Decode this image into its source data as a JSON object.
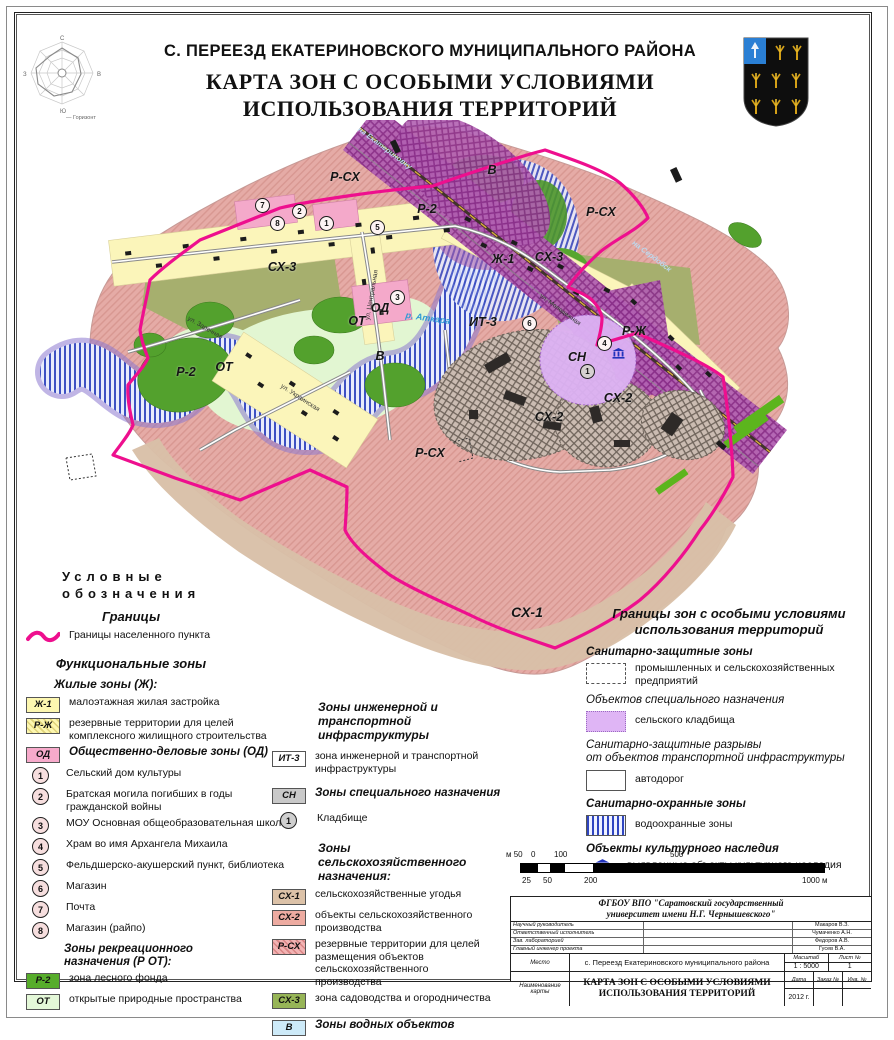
{
  "header": {
    "subtitle": "С. ПЕРЕЕЗД ЕКАТЕРИНОВСКОГО МУНИЦИПАЛЬНОГО РАЙОНА",
    "title_l1": "КАРТА ЗОН С ОСОБЫМИ УСЛОВИЯМИ",
    "title_l2": "ИСПОЛЬЗОВАНИЯ ТЕРРИТОРИЙ",
    "compass": {
      "n": "С",
      "e": "В",
      "s": "Ю",
      "w": "З",
      "caption": "— Горизонт"
    }
  },
  "map": {
    "zone_labels": [
      {
        "t": "Р-СХ"
      },
      {
        "t": "Р-СХ"
      },
      {
        "t": "Р-СХ"
      },
      {
        "t": "СХ-3"
      },
      {
        "t": "СХ-3"
      },
      {
        "t": "Ж-1"
      },
      {
        "t": "Р-2"
      },
      {
        "t": "Р-2"
      },
      {
        "t": "ОТ"
      },
      {
        "t": "ОТ"
      },
      {
        "t": "В"
      },
      {
        "t": "В"
      },
      {
        "t": "ОД"
      },
      {
        "t": "ИТ-3"
      },
      {
        "t": "СН"
      },
      {
        "t": "СХ-2"
      },
      {
        "t": "СХ-2"
      },
      {
        "t": "Р-Ж"
      },
      {
        "t": "СХ-1"
      }
    ],
    "street_labels": [
      {
        "t": "ул. Заречная"
      },
      {
        "t": "ул. Центральная"
      },
      {
        "t": "ул. Украинская"
      },
      {
        "t": "ул. Молодежная"
      }
    ],
    "direction_labels": [
      {
        "t": "на Екатериновку"
      },
      {
        "t": "на Сердобск"
      }
    ],
    "river_label": "р. Аткара",
    "markers": [
      {
        "n": "7"
      },
      {
        "n": "2"
      },
      {
        "n": "8"
      },
      {
        "n": "1"
      },
      {
        "n": "5"
      },
      {
        "n": "3"
      },
      {
        "n": "6"
      },
      {
        "n": "4"
      },
      {
        "n": "1"
      }
    ]
  },
  "legend_left": {
    "head_l1": "Условные",
    "head_l2": "обозначения",
    "borders_title": "Границы",
    "border_label": "Границы населенного пункта",
    "functional_title": "Функциональные зоны",
    "residential_title": "Жилые зоны (Ж):",
    "rows": [
      {
        "code": "Ж-1",
        "label": "малоэтажная жилая застройка"
      },
      {
        "code": "Р-Ж",
        "label": "резервные территории для целей комплексного жилищного строительства"
      },
      {
        "code": "ОД",
        "label": "Общественно-деловые зоны (ОД)"
      },
      {
        "code": "1",
        "label": "Сельский дом культуры"
      },
      {
        "code": "2",
        "label": "Братская могила погибших в годы гражданской войны"
      },
      {
        "code": "3",
        "label": "МОУ Основная общеобразовательная школа"
      },
      {
        "code": "4",
        "label": "Храм во имя Архангела Михаила"
      },
      {
        "code": "5",
        "label": "Фельдшерско-акушерский пункт, библиотека"
      },
      {
        "code": "6",
        "label": "Магазин"
      },
      {
        "code": "7",
        "label": "Почта"
      },
      {
        "code": "8",
        "label": "Магазин (райпо)"
      },
      {
        "code": "",
        "label": "Зоны рекреационного назначения (Р ОТ):"
      },
      {
        "code": "Р-2",
        "label": "зона лесного фонда"
      },
      {
        "code": "ОТ",
        "label": "открытые природные пространства"
      }
    ]
  },
  "legend_mid": {
    "infra_title": "Зоны инженерной и транспортной инфраструктуры",
    "agro_title": "Зоны сельскохозяйственного назначения:",
    "rows": [
      {
        "code": "ИТ-3",
        "label": "зона инженерной и транспортной инфраструктуры"
      },
      {
        "code": "СН",
        "label": "Зоны специального назначения"
      },
      {
        "code": "1",
        "label": "Кладбище"
      },
      {
        "code": "СХ-1",
        "label": "сельскохозяйственные угодья"
      },
      {
        "code": "СХ-2",
        "label": "объекты сельскохозяйственного производства"
      },
      {
        "code": "Р-СХ",
        "label": "резервные территории для целей размещения объектов сельскохозяйственного производства"
      },
      {
        "code": "СХ-3",
        "label": "зона садоводства и огородничества"
      },
      {
        "code": "В",
        "label": "Зоны водных объектов"
      }
    ]
  },
  "legend_right": {
    "title_l1": "Границы зон с особыми условиями",
    "title_l2": "использования территорий",
    "szz_title": "Санитарно-защитные зоны",
    "industrial_label": "промышленных и сельскохозяйственных предприятий",
    "special_title": "Объектов специального назначения",
    "cemetery_label": "сельского кладбища",
    "gap_title_l1": "Санитарно-защитные разрывы",
    "gap_title_l2": "от объектов транспортной инфраструктуры",
    "roads_label": "автодорог",
    "guard_title": "Санитарно-охранные зоны",
    "water_label": "водоохранные зоны",
    "heritage_title": "Объекты культурного наследия",
    "heritage_label": "выявленные объекты культурного наследия"
  },
  "scalebar": {
    "top": [
      "м 50",
      "0",
      "100",
      "500"
    ],
    "bottom": [
      "25",
      "50",
      "200",
      "1000 м"
    ]
  },
  "title_block": {
    "org_l1": "ФГБОУ ВПО \"Саратовский государственный",
    "org_l2": "университет имени Н.Г. Чернышевского\"",
    "roles": [
      [
        "Научный руководитель",
        "Макаров В.З."
      ],
      [
        "Ответственный исполнитель",
        "Чумаченко А.Н."
      ],
      [
        "Зав. лабораторией",
        "Федоров А.В."
      ],
      [
        "Главный инженер проекта",
        "Гусев В.А."
      ]
    ],
    "place_label": "Место",
    "place_value": "с. Переезд Екатериновского муниципального района",
    "name_label": "Наименование карты",
    "map_name_l1": "КАРТА ЗОН С ОСОБЫМИ УСЛОВИЯМИ",
    "map_name_l2": "ИСПОЛЬЗОВАНИЯ ТЕРРИТОРИЙ",
    "scale_label": "Масштаб",
    "scale_value": "1 : 5000",
    "sheet_label": "Лист №",
    "sheet_value": "1",
    "date_label": "Дата",
    "order_label": "Заказ №",
    "inv_label": "Инв. №",
    "date_value": "2012 г."
  },
  "colors": {
    "boundary": "#ee0f8e",
    "residential_yellow": "#fbf5ba",
    "reserve_pink": "#e5aba6",
    "farmland_tan": "#d8bfa8",
    "forest_green": "#53a12d",
    "open_green": "#e2f6d2",
    "rail_purple": "#b160b1",
    "cemetery_purple": "#ddb2f4",
    "water_stripe_blue": "#3d50c3",
    "sanitary_gray": "#cbbcb2",
    "heritage_blue": "#2233bb"
  }
}
